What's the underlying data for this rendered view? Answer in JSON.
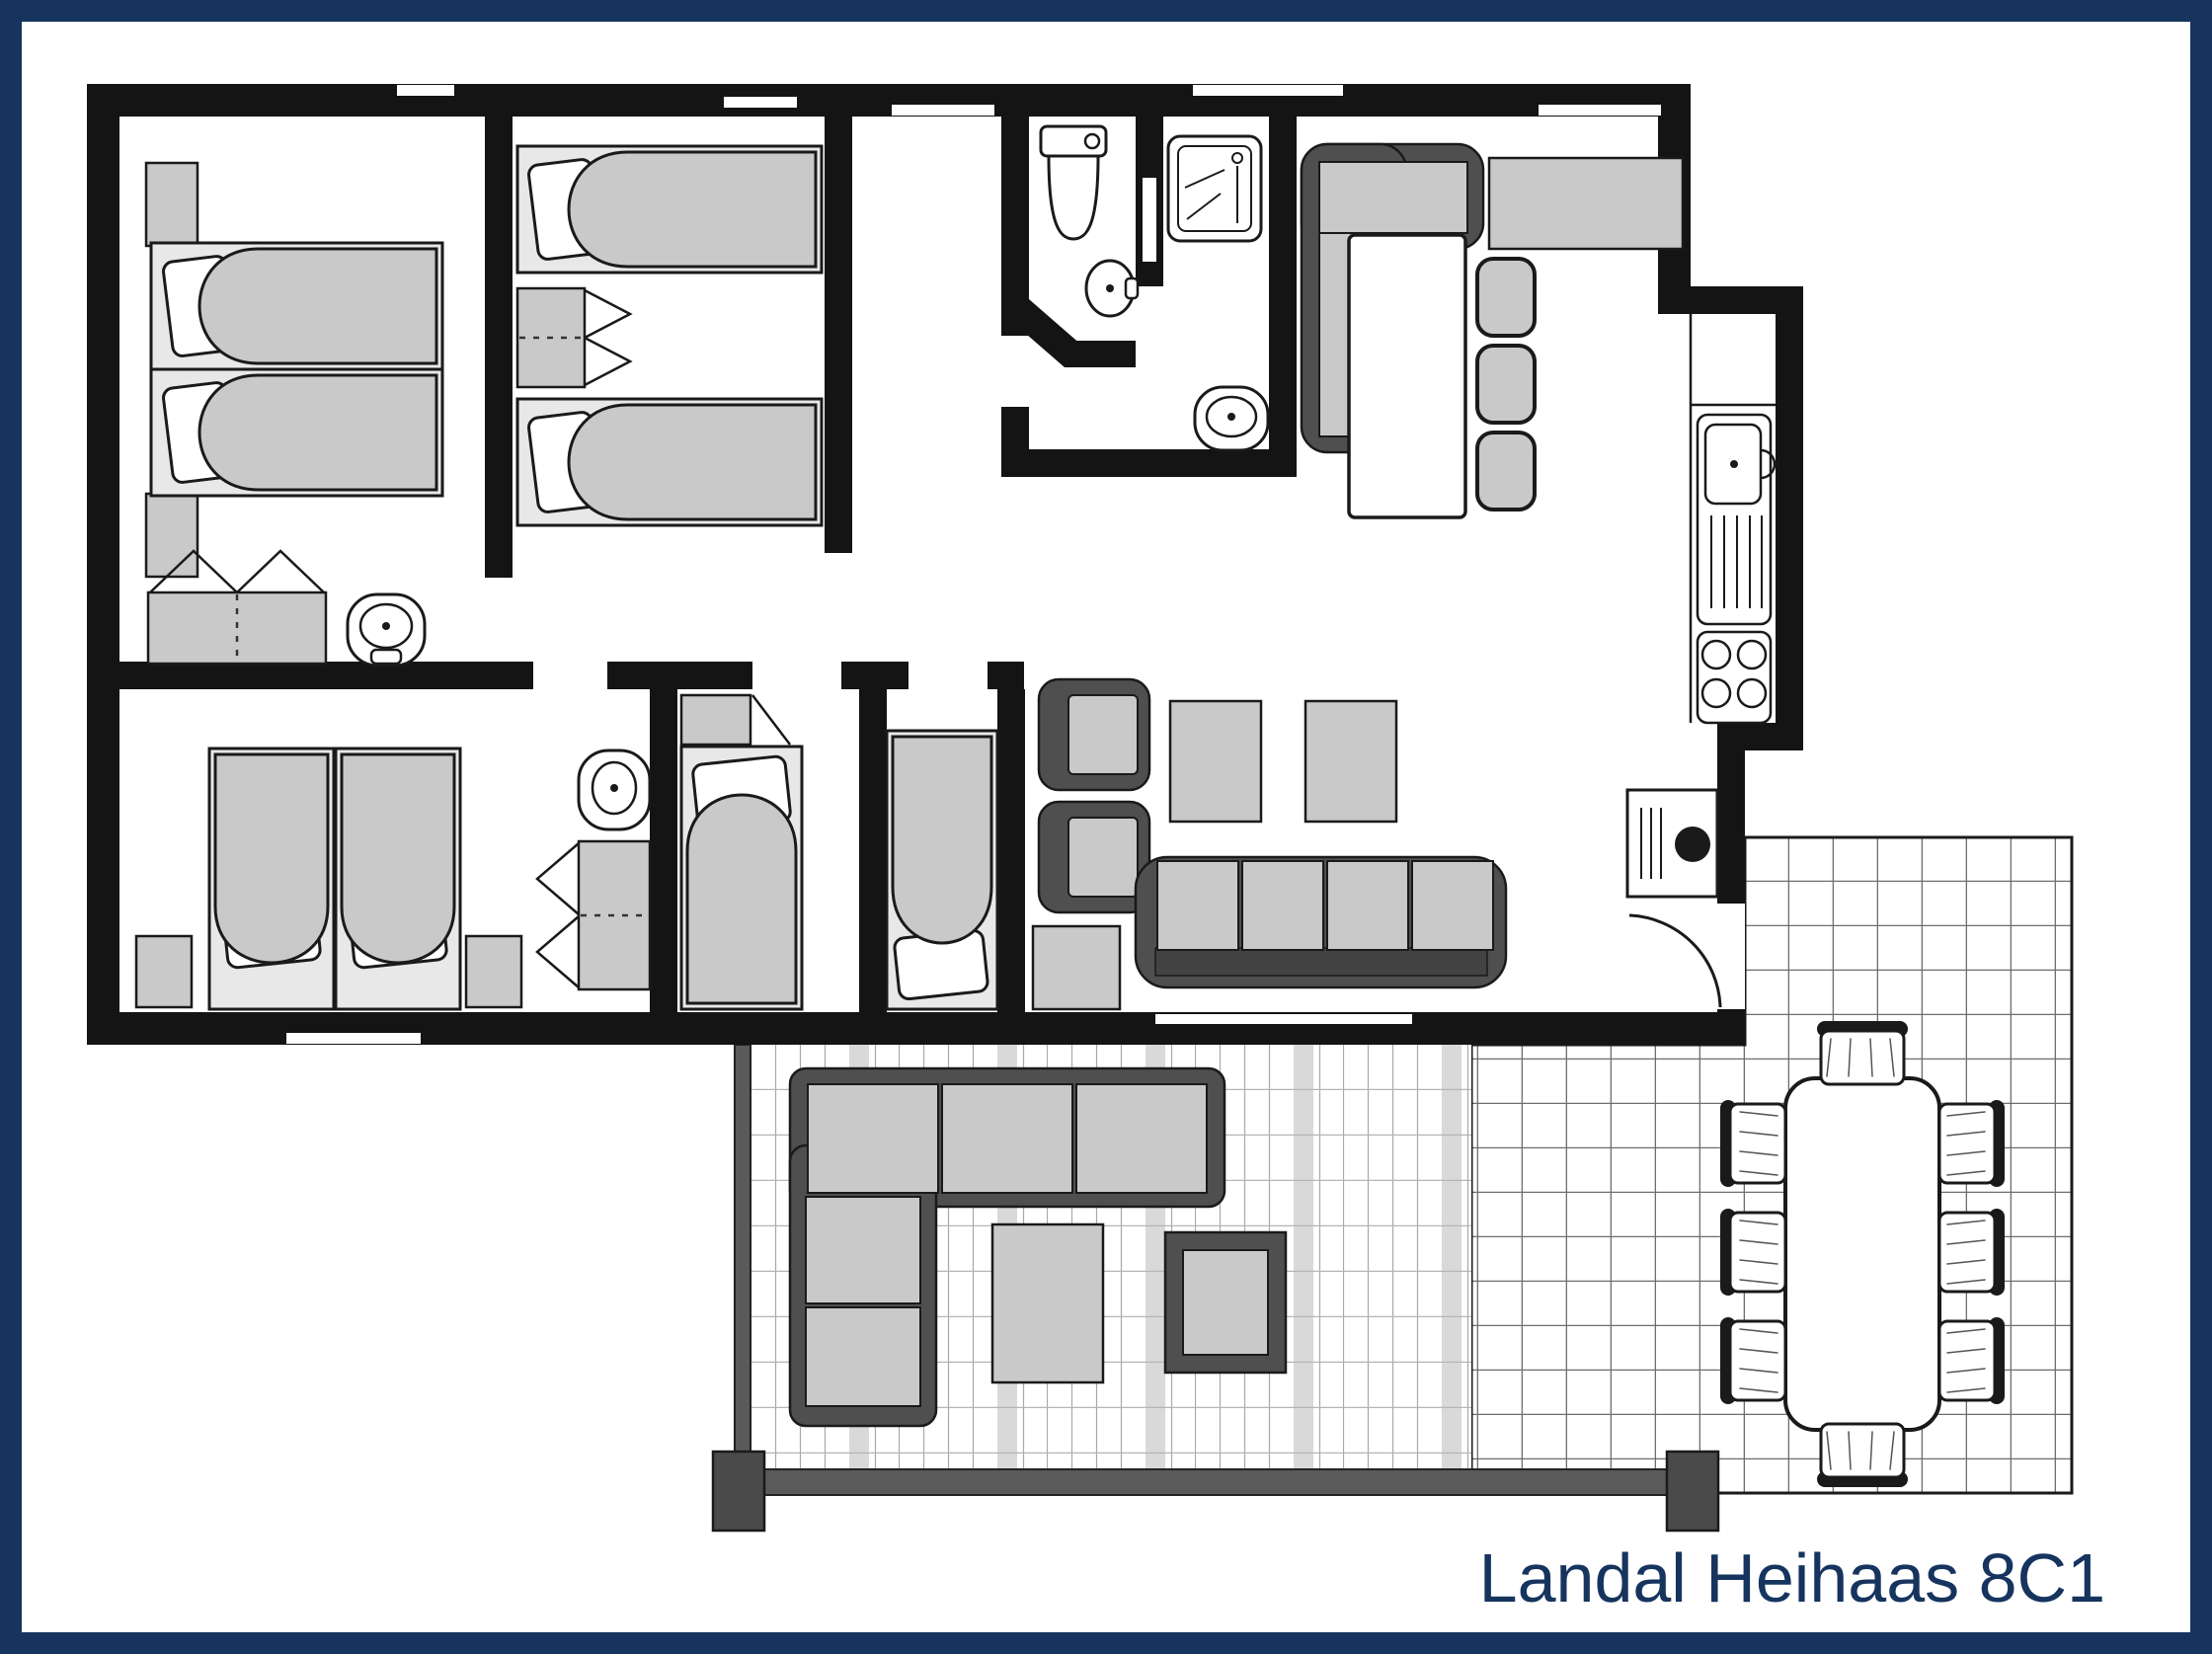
{
  "title": {
    "label": "Landal Heihaas 8C1"
  },
  "colors": {
    "frame_navy": "#16345E",
    "title_navy": "#16345E",
    "wall_black": "#141414",
    "paper_white": "#FFFFFF",
    "furniture_light": "#C9C9C9",
    "bedframe_light": "#E8E8E8",
    "furniture_dark": "#4F4F4F",
    "terrace_beam": "#5A5A5A",
    "tile_line": "#6E6E6E",
    "plank_line": "#A8A8A8",
    "plank_band": "#D9D9D9"
  },
  "inventory": {
    "bedrooms": 5,
    "single_beds": 8,
    "wardrobes": 4,
    "sinks": 5,
    "toilets": 1,
    "showers": 1,
    "hob_burners": 4,
    "indoor_dining_chairs": 3,
    "dining_bench_sections": 2,
    "sofa_seats": 4,
    "armchairs": 2,
    "coffee_tables": 2,
    "terraces": 2,
    "terrace_dining_chairs": 8,
    "terrace_lounge_cushions": 5
  }
}
